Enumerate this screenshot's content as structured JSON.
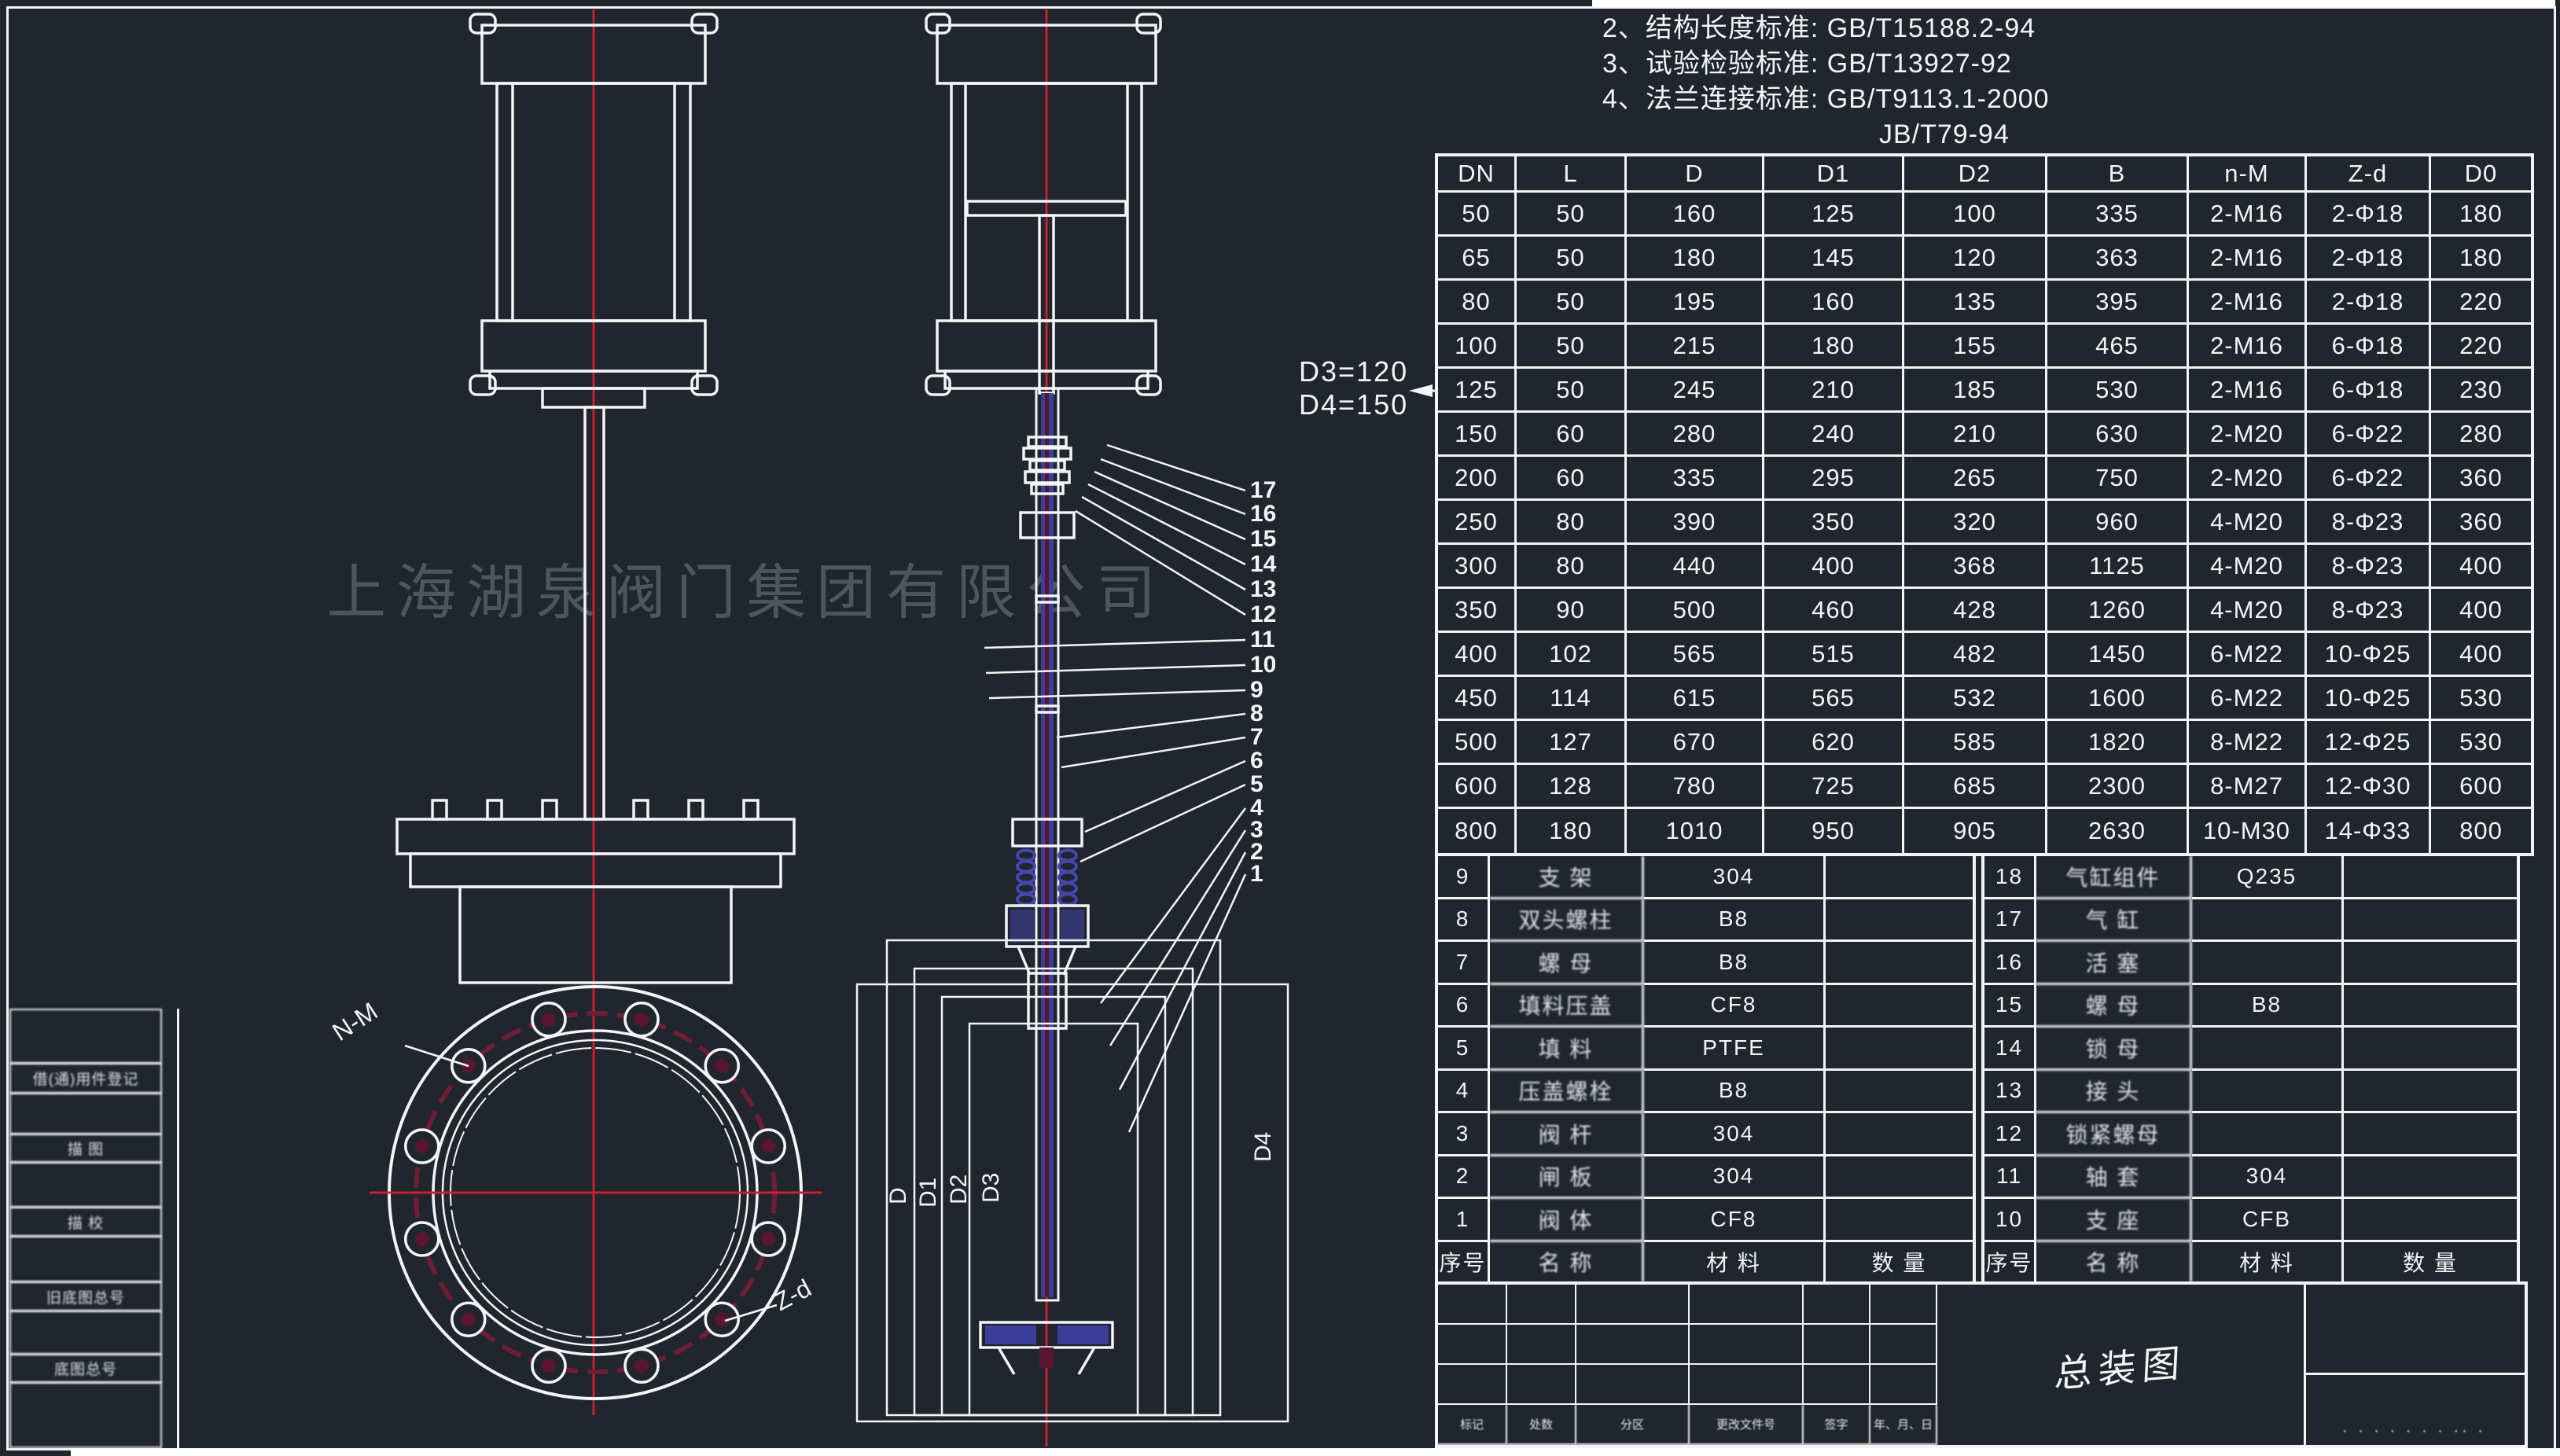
{
  "notes": {
    "line2": "2、结构长度标准: GB/T15188.2-94",
    "line3": "3、试验检验标准: GB/T13927-92",
    "line4": "4、法兰连接标准: GB/T9113.1-2000",
    "line4b": "JB/T79-94"
  },
  "watermark": "上海湖泉阀门集团有限公司",
  "annotations": {
    "d3_label": "D3=120",
    "d4_label": "D4=150",
    "flange_bolt_label": "N-M",
    "flange_hole_label": "Z-d",
    "dim_labels": [
      "D",
      "D1",
      "D2",
      "D3",
      "D4"
    ],
    "callouts": [
      "17",
      "16",
      "15",
      "14",
      "13",
      "12",
      "11",
      "10",
      "9",
      "8",
      "7",
      "6",
      "5",
      "4",
      "3",
      "2",
      "1"
    ]
  },
  "dimension_table": {
    "headers": [
      "DN",
      "L",
      "D",
      "D1",
      "D2",
      "B",
      "n-M",
      "Z-d",
      "D0"
    ],
    "rows": [
      [
        "50",
        "50",
        "160",
        "125",
        "100",
        "335",
        "2-M16",
        "2-Φ18",
        "180"
      ],
      [
        "65",
        "50",
        "180",
        "145",
        "120",
        "363",
        "2-M16",
        "2-Φ18",
        "180"
      ],
      [
        "80",
        "50",
        "195",
        "160",
        "135",
        "395",
        "2-M16",
        "2-Φ18",
        "220"
      ],
      [
        "100",
        "50",
        "215",
        "180",
        "155",
        "465",
        "2-M16",
        "6-Φ18",
        "220"
      ],
      [
        "125",
        "50",
        "245",
        "210",
        "185",
        "530",
        "2-M16",
        "6-Φ18",
        "230"
      ],
      [
        "150",
        "60",
        "280",
        "240",
        "210",
        "630",
        "2-M20",
        "6-Φ22",
        "280"
      ],
      [
        "200",
        "60",
        "335",
        "295",
        "265",
        "750",
        "2-M20",
        "6-Φ22",
        "360"
      ],
      [
        "250",
        "80",
        "390",
        "350",
        "320",
        "960",
        "4-M20",
        "8-Φ23",
        "360"
      ],
      [
        "300",
        "80",
        "440",
        "400",
        "368",
        "1125",
        "4-M20",
        "8-Φ23",
        "400"
      ],
      [
        "350",
        "90",
        "500",
        "460",
        "428",
        "1260",
        "4-M20",
        "8-Φ23",
        "400"
      ],
      [
        "400",
        "102",
        "565",
        "515",
        "482",
        "1450",
        "6-M22",
        "10-Φ25",
        "400"
      ],
      [
        "450",
        "114",
        "615",
        "565",
        "532",
        "1600",
        "6-M22",
        "10-Φ25",
        "530"
      ],
      [
        "500",
        "127",
        "670",
        "620",
        "585",
        "1820",
        "8-M22",
        "12-Φ25",
        "530"
      ],
      [
        "600",
        "128",
        "780",
        "725",
        "685",
        "2300",
        "8-M27",
        "12-Φ30",
        "600"
      ],
      [
        "800",
        "180",
        "1010",
        "950",
        "905",
        "2630",
        "10-M30",
        "14-Φ33",
        "800"
      ]
    ]
  },
  "parts_list": {
    "headers": [
      "序号",
      "名 称",
      "材 料",
      "数 量"
    ],
    "left": [
      {
        "no": "9",
        "name": "支 架",
        "material": "304",
        "qty": ""
      },
      {
        "no": "8",
        "name": "双头螺柱",
        "material": "B8",
        "qty": ""
      },
      {
        "no": "7",
        "name": "螺 母",
        "material": "B8",
        "qty": ""
      },
      {
        "no": "6",
        "name": "填料压盖",
        "material": "CF8",
        "qty": ""
      },
      {
        "no": "5",
        "name": "填 料",
        "material": "PTFE",
        "qty": ""
      },
      {
        "no": "4",
        "name": "压盖螺栓",
        "material": "B8",
        "qty": ""
      },
      {
        "no": "3",
        "name": "阀 杆",
        "material": "304",
        "qty": ""
      },
      {
        "no": "2",
        "name": "闸 板",
        "material": "304",
        "qty": ""
      },
      {
        "no": "1",
        "name": "阀 体",
        "material": "CF8",
        "qty": ""
      }
    ],
    "right": [
      {
        "no": "18",
        "name": "气缸组件",
        "material": "Q235",
        "qty": ""
      },
      {
        "no": "17",
        "name": "气 缸",
        "material": "",
        "qty": ""
      },
      {
        "no": "16",
        "name": "活 塞",
        "material": "",
        "qty": ""
      },
      {
        "no": "15",
        "name": "螺 母",
        "material": "B8",
        "qty": ""
      },
      {
        "no": "14",
        "name": "锁 母",
        "material": "",
        "qty": ""
      },
      {
        "no": "13",
        "name": "接 头",
        "material": "",
        "qty": ""
      },
      {
        "no": "12",
        "name": "锁紧螺母",
        "material": "",
        "qty": ""
      },
      {
        "no": "11",
        "name": "轴 套",
        "material": "304",
        "qty": ""
      },
      {
        "no": "10",
        "name": "支 座",
        "material": "CFB",
        "qty": ""
      }
    ]
  },
  "title_block": {
    "title": "总装图",
    "revision_labels": [
      "标记",
      "处数",
      "分区",
      "更改文件号",
      "签字",
      "年、月、日"
    ],
    "scale_dots": "· · ·  ·  · ·  · ··  ·"
  },
  "margin_labels": [
    "借(通)用件登记",
    "描 图",
    "描 校",
    "旧底图总号",
    "底图总号"
  ],
  "colors": {
    "background": "#20252e",
    "line_white": "#f2f4f6",
    "centerline_red": "#c8202c",
    "bolt_circle_red": "#6e1e34",
    "fill_red": "#5a1630",
    "stem_blue": "#3c3f9a",
    "fill_blue": "#34376f"
  }
}
